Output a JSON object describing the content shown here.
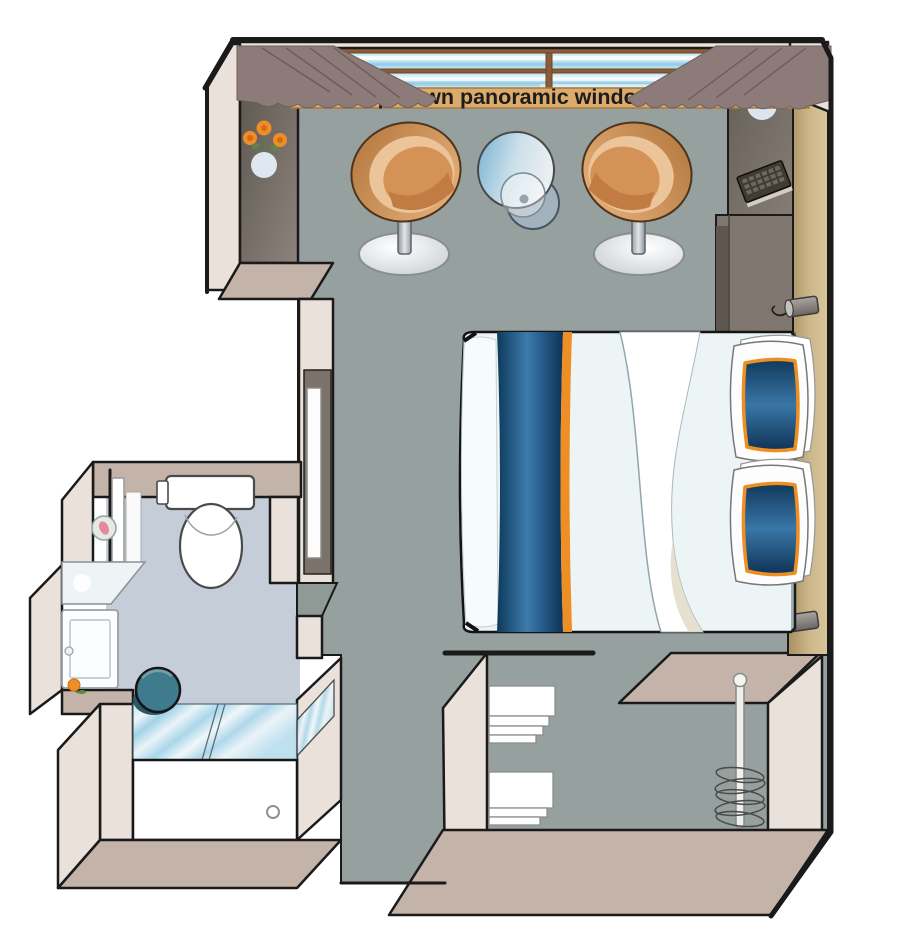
{
  "floorplan": {
    "window_label": "Drop-down panoramic windows",
    "colors": {
      "floor_main": "#96a09e",
      "floor_bathroom": "#c4cdd8",
      "wall_face": "#e9e1da",
      "wall_top": "#c4b3a8",
      "wall_right_tan": "#c2a87e",
      "dark_cabinet": "#6f6862",
      "window_glass": "#a9d9ee",
      "window_frame": "#8a5c38",
      "window_sill": "#dcab6b",
      "curtain": "#8d7b79",
      "chair_copper": "#c8895a",
      "table_glass": "#9cc6dd",
      "bed_runner_blue": "#16405f",
      "pillow_blue": "#2f6a9a",
      "accent_orange": "#ee8f25",
      "stool_teal": "#3e7b8d",
      "outline": "#1a1a1a",
      "label_text": "#1c1c1c"
    },
    "items": [
      "panoramic-window",
      "curtain-left",
      "curtain-right",
      "armchair-left",
      "armchair-right",
      "glass-side-table",
      "flower-vase-wall",
      "desk-unit",
      "flower-vase-desk",
      "keyboard",
      "wall-lamp-upper",
      "wall-lamp-lower",
      "double-bed",
      "pillow-top",
      "pillow-bottom",
      "entry-door",
      "toilet",
      "bathroom-mirror",
      "washbasin-counter",
      "vanity-cabinet",
      "stool",
      "shower-glass",
      "shower-tray",
      "towel-shelves",
      "wardrobe-hanging-rail"
    ]
  }
}
